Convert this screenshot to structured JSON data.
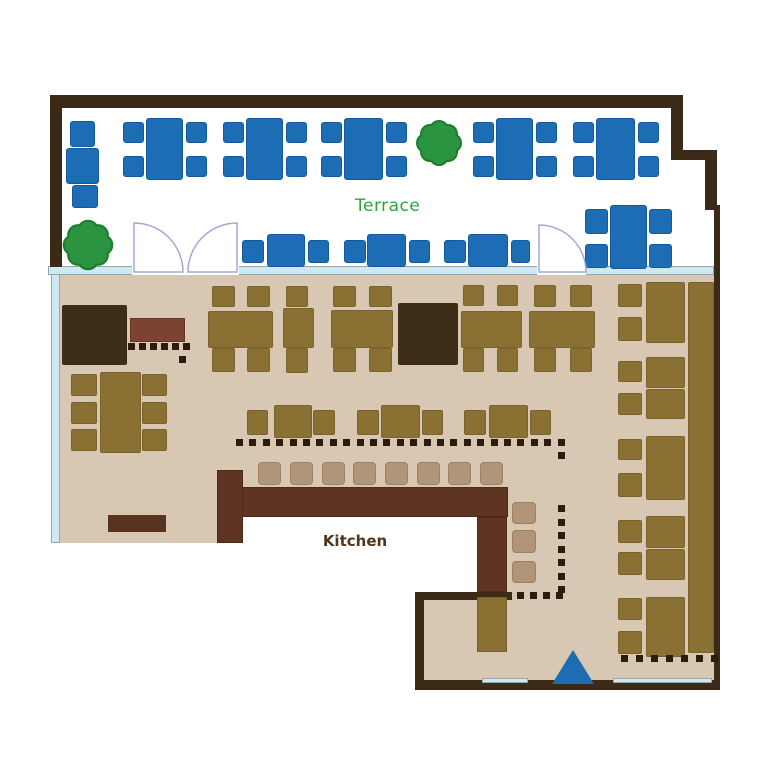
{
  "labels": {
    "terrace": "Terrace",
    "counter": "カウンター",
    "kitchen": "Kitchen"
  },
  "colors": {
    "wall": "#3a2a16",
    "floor": "#d8c7b2",
    "window": "#cfe9f3",
    "white": "#ffffff",
    "blue": "#1d6db5",
    "olive": "#8b7033",
    "dark": "#3f2e17",
    "counter": "#5f3422",
    "stool": "#b29478",
    "red": "#7d4331",
    "ledge": "#57341f",
    "dot": "#2b1c0e",
    "tree": "#2b9440",
    "treeStroke": "#1d7c2d",
    "door": "#a3a8d6",
    "terraceText": "#2aa53c",
    "kitchenText": "#54351b",
    "counterText": "#ffffff"
  },
  "borders": {
    "blue": "#1359a2",
    "olive": "#7a632b",
    "stool": "#9e8164",
    "window": "#97a6ad",
    "counter": "#4e2a18",
    "red": "#6a3322"
  },
  "shapes": [
    {
      "n": "indoor-floor-main",
      "c": "floor",
      "x": 58,
      "y": 275,
      "w": 656,
      "h": 242
    },
    {
      "n": "indoor-floor-left-lip",
      "c": "floor",
      "x": 58,
      "y": 517,
      "w": 160,
      "h": 26
    },
    {
      "n": "indoor-floor-right",
      "c": "floor",
      "x": 507,
      "y": 517,
      "w": 207,
      "h": 167
    },
    {
      "n": "indoor-floor-bottom-mid",
      "c": "floor",
      "x": 424,
      "y": 600,
      "w": 83,
      "h": 84
    },
    {
      "n": "window-band-left",
      "c": "window",
      "x": 51,
      "y": 266,
      "w": 9,
      "h": 277
    },
    {
      "n": "terrace-divider-band",
      "c": "window",
      "x": 48,
      "y": 266,
      "w": 666,
      "h": 9
    },
    {
      "n": "divider-door-gap",
      "c": "white",
      "x": 132,
      "y": 266,
      "w": 107,
      "h": 9
    },
    {
      "n": "divider-door-gap",
      "c": "white",
      "x": 537,
      "y": 266,
      "w": 49,
      "h": 9
    },
    {
      "n": "wall-top",
      "c": "wall",
      "x": 50,
      "y": 95,
      "w": 633,
      "h": 13
    },
    {
      "n": "wall-left",
      "c": "wall",
      "x": 50,
      "y": 95,
      "w": 12,
      "h": 172
    },
    {
      "n": "wall-right-upper",
      "c": "wall",
      "x": 671,
      "y": 95,
      "w": 12,
      "h": 62
    },
    {
      "n": "wall-right-step",
      "c": "wall",
      "x": 671,
      "y": 150,
      "w": 46,
      "h": 10
    },
    {
      "n": "wall-right-mid",
      "c": "wall",
      "x": 705,
      "y": 150,
      "w": 12,
      "h": 60
    },
    {
      "n": "wall-right-thin",
      "c": "wall",
      "x": 714,
      "y": 205,
      "w": 6,
      "h": 485
    },
    {
      "n": "wall-bottom",
      "c": "wall",
      "x": 415,
      "y": 680,
      "w": 305,
      "h": 10
    },
    {
      "n": "wall-kitchen-corner-v",
      "c": "wall",
      "x": 415,
      "y": 592,
      "w": 9,
      "h": 95
    },
    {
      "n": "wall-kitchen-corner-h",
      "c": "wall",
      "x": 415,
      "y": 592,
      "w": 97,
      "h": 8
    },
    {
      "n": "entrance-glass",
      "c": "window",
      "x": 482,
      "y": 678,
      "w": 46,
      "h": 5
    },
    {
      "n": "entrance-glass",
      "c": "window",
      "x": 613,
      "y": 678,
      "w": 99,
      "h": 5
    },
    {
      "n": "private-room-block",
      "c": "dark",
      "x": 62,
      "y": 305,
      "w": 65,
      "h": 60,
      "r": 2
    },
    {
      "n": "private-room-block",
      "c": "dark",
      "x": 398,
      "y": 303,
      "w": 60,
      "h": 62,
      "r": 2
    },
    {
      "n": "service-bench",
      "c": "red",
      "x": 130,
      "y": 318,
      "w": 55,
      "h": 24
    },
    {
      "n": "bottom-ledge",
      "c": "ledge",
      "x": 108,
      "y": 515,
      "w": 58,
      "h": 17
    },
    {
      "n": "terrace-chair",
      "c": "blue",
      "x": 70,
      "y": 121,
      "w": 25,
      "h": 26,
      "r": 3
    },
    {
      "n": "terrace-table",
      "c": "blue",
      "x": 66,
      "y": 148,
      "w": 33,
      "h": 36,
      "r": 3
    },
    {
      "n": "terrace-chair",
      "c": "blue",
      "x": 72,
      "y": 185,
      "w": 26,
      "h": 23,
      "r": 3
    },
    {
      "n": "terrace-table",
      "c": "blue",
      "x": 146,
      "y": 118,
      "w": 37,
      "h": 62,
      "r": 3
    },
    {
      "n": "terrace-chair",
      "c": "blue",
      "x": 123,
      "y": 122,
      "w": 21,
      "h": 21,
      "r": 3
    },
    {
      "n": "terrace-chair",
      "c": "blue",
      "x": 123,
      "y": 156,
      "w": 21,
      "h": 21,
      "r": 3
    },
    {
      "n": "terrace-chair",
      "c": "blue",
      "x": 186,
      "y": 122,
      "w": 21,
      "h": 21,
      "r": 3
    },
    {
      "n": "terrace-chair",
      "c": "blue",
      "x": 186,
      "y": 156,
      "w": 21,
      "h": 21,
      "r": 3
    },
    {
      "n": "terrace-table",
      "c": "blue",
      "x": 246,
      "y": 118,
      "w": 37,
      "h": 62,
      "r": 3
    },
    {
      "n": "terrace-chair",
      "c": "blue",
      "x": 223,
      "y": 122,
      "w": 21,
      "h": 21,
      "r": 3
    },
    {
      "n": "terrace-chair",
      "c": "blue",
      "x": 223,
      "y": 156,
      "w": 21,
      "h": 21,
      "r": 3
    },
    {
      "n": "terrace-chair",
      "c": "blue",
      "x": 286,
      "y": 122,
      "w": 21,
      "h": 21,
      "r": 3
    },
    {
      "n": "terrace-chair",
      "c": "blue",
      "x": 286,
      "y": 156,
      "w": 21,
      "h": 21,
      "r": 3
    },
    {
      "n": "terrace-table",
      "c": "blue",
      "x": 344,
      "y": 118,
      "w": 39,
      "h": 62,
      "r": 3
    },
    {
      "n": "terrace-chair",
      "c": "blue",
      "x": 321,
      "y": 122,
      "w": 21,
      "h": 21,
      "r": 3
    },
    {
      "n": "terrace-chair",
      "c": "blue",
      "x": 321,
      "y": 156,
      "w": 21,
      "h": 21,
      "r": 3
    },
    {
      "n": "terrace-chair",
      "c": "blue",
      "x": 386,
      "y": 122,
      "w": 21,
      "h": 21,
      "r": 3
    },
    {
      "n": "terrace-chair",
      "c": "blue",
      "x": 386,
      "y": 156,
      "w": 21,
      "h": 21,
      "r": 3
    },
    {
      "n": "terrace-table",
      "c": "blue",
      "x": 496,
      "y": 118,
      "w": 37,
      "h": 62,
      "r": 3
    },
    {
      "n": "terrace-chair",
      "c": "blue",
      "x": 473,
      "y": 122,
      "w": 21,
      "h": 21,
      "r": 3
    },
    {
      "n": "terrace-chair",
      "c": "blue",
      "x": 473,
      "y": 156,
      "w": 21,
      "h": 21,
      "r": 3
    },
    {
      "n": "terrace-chair",
      "c": "blue",
      "x": 536,
      "y": 122,
      "w": 21,
      "h": 21,
      "r": 3
    },
    {
      "n": "terrace-chair",
      "c": "blue",
      "x": 536,
      "y": 156,
      "w": 21,
      "h": 21,
      "r": 3
    },
    {
      "n": "terrace-table",
      "c": "blue",
      "x": 596,
      "y": 118,
      "w": 39,
      "h": 62,
      "r": 3
    },
    {
      "n": "terrace-chair",
      "c": "blue",
      "x": 573,
      "y": 122,
      "w": 21,
      "h": 21,
      "r": 3
    },
    {
      "n": "terrace-chair",
      "c": "blue",
      "x": 573,
      "y": 156,
      "w": 21,
      "h": 21,
      "r": 3
    },
    {
      "n": "terrace-chair",
      "c": "blue",
      "x": 638,
      "y": 122,
      "w": 21,
      "h": 21,
      "r": 3
    },
    {
      "n": "terrace-chair",
      "c": "blue",
      "x": 638,
      "y": 156,
      "w": 21,
      "h": 21,
      "r": 3
    },
    {
      "n": "terrace-chair",
      "c": "blue",
      "x": 242,
      "y": 240,
      "w": 22,
      "h": 23,
      "r": 3
    },
    {
      "n": "terrace-table",
      "c": "blue",
      "x": 267,
      "y": 234,
      "w": 38,
      "h": 33,
      "r": 3
    },
    {
      "n": "terrace-chair",
      "c": "blue",
      "x": 308,
      "y": 240,
      "w": 21,
      "h": 23,
      "r": 3
    },
    {
      "n": "terrace-chair",
      "c": "blue",
      "x": 344,
      "y": 240,
      "w": 22,
      "h": 23,
      "r": 3
    },
    {
      "n": "terrace-table",
      "c": "blue",
      "x": 367,
      "y": 234,
      "w": 39,
      "h": 33,
      "r": 3
    },
    {
      "n": "terrace-chair",
      "c": "blue",
      "x": 409,
      "y": 240,
      "w": 21,
      "h": 23,
      "r": 3
    },
    {
      "n": "terrace-chair",
      "c": "blue",
      "x": 444,
      "y": 240,
      "w": 22,
      "h": 23,
      "r": 3
    },
    {
      "n": "terrace-table",
      "c": "blue",
      "x": 468,
      "y": 234,
      "w": 40,
      "h": 33,
      "r": 3
    },
    {
      "n": "terrace-chair",
      "c": "blue",
      "x": 511,
      "y": 240,
      "w": 19,
      "h": 23,
      "r": 3
    },
    {
      "n": "terrace-table",
      "c": "blue",
      "x": 610,
      "y": 205,
      "w": 37,
      "h": 64,
      "r": 3
    },
    {
      "n": "terrace-chair",
      "c": "blue",
      "x": 585,
      "y": 209,
      "w": 23,
      "h": 25,
      "r": 3
    },
    {
      "n": "terrace-chair",
      "c": "blue",
      "x": 585,
      "y": 244,
      "w": 23,
      "h": 24,
      "r": 3
    },
    {
      "n": "terrace-chair",
      "c": "blue",
      "x": 649,
      "y": 209,
      "w": 23,
      "h": 25,
      "r": 3
    },
    {
      "n": "terrace-chair",
      "c": "blue",
      "x": 649,
      "y": 244,
      "w": 23,
      "h": 24,
      "r": 3
    },
    {
      "n": "dining-table",
      "c": "olive",
      "x": 208,
      "y": 311,
      "w": 65,
      "h": 37,
      "r": 2
    },
    {
      "n": "dining-chair",
      "c": "olive",
      "x": 212,
      "y": 286,
      "w": 23,
      "h": 21,
      "r": 2
    },
    {
      "n": "dining-chair",
      "c": "olive",
      "x": 247,
      "y": 286,
      "w": 23,
      "h": 21,
      "r": 2
    },
    {
      "n": "dining-chair",
      "c": "olive",
      "x": 212,
      "y": 348,
      "w": 23,
      "h": 24,
      "r": 2
    },
    {
      "n": "dining-chair",
      "c": "olive",
      "x": 247,
      "y": 348,
      "w": 23,
      "h": 24,
      "r": 2
    },
    {
      "n": "dining-table",
      "c": "olive",
      "x": 283,
      "y": 308,
      "w": 31,
      "h": 40,
      "r": 2
    },
    {
      "n": "dining-chair",
      "c": "olive",
      "x": 286,
      "y": 286,
      "w": 22,
      "h": 21,
      "r": 2
    },
    {
      "n": "dining-chair",
      "c": "olive",
      "x": 286,
      "y": 348,
      "w": 22,
      "h": 25,
      "r": 2
    },
    {
      "n": "dining-table",
      "c": "olive",
      "x": 331,
      "y": 310,
      "w": 62,
      "h": 38,
      "r": 2
    },
    {
      "n": "dining-chair",
      "c": "olive",
      "x": 333,
      "y": 286,
      "w": 23,
      "h": 21,
      "r": 2
    },
    {
      "n": "dining-chair",
      "c": "olive",
      "x": 369,
      "y": 286,
      "w": 23,
      "h": 21,
      "r": 2
    },
    {
      "n": "dining-chair",
      "c": "olive",
      "x": 333,
      "y": 348,
      "w": 23,
      "h": 24,
      "r": 2
    },
    {
      "n": "dining-chair",
      "c": "olive",
      "x": 369,
      "y": 348,
      "w": 23,
      "h": 24,
      "r": 2
    },
    {
      "n": "dining-table",
      "c": "olive",
      "x": 461,
      "y": 311,
      "w": 61,
      "h": 37,
      "r": 2
    },
    {
      "n": "dining-chair",
      "c": "olive",
      "x": 463,
      "y": 285,
      "w": 21,
      "h": 21,
      "r": 2
    },
    {
      "n": "dining-chair",
      "c": "olive",
      "x": 497,
      "y": 285,
      "w": 21,
      "h": 21,
      "r": 2
    },
    {
      "n": "dining-chair",
      "c": "olive",
      "x": 463,
      "y": 348,
      "w": 21,
      "h": 24,
      "r": 2
    },
    {
      "n": "dining-chair",
      "c": "olive",
      "x": 497,
      "y": 348,
      "w": 21,
      "h": 24,
      "r": 2
    },
    {
      "n": "dining-table",
      "c": "olive",
      "x": 529,
      "y": 311,
      "w": 66,
      "h": 37,
      "r": 2
    },
    {
      "n": "dining-chair",
      "c": "olive",
      "x": 534,
      "y": 285,
      "w": 22,
      "h": 22,
      "r": 2
    },
    {
      "n": "dining-chair",
      "c": "olive",
      "x": 570,
      "y": 285,
      "w": 22,
      "h": 22,
      "r": 2
    },
    {
      "n": "dining-chair",
      "c": "olive",
      "x": 534,
      "y": 348,
      "w": 22,
      "h": 24,
      "r": 2
    },
    {
      "n": "dining-chair",
      "c": "olive",
      "x": 570,
      "y": 348,
      "w": 22,
      "h": 24,
      "r": 2
    },
    {
      "n": "dining-table",
      "c": "olive",
      "x": 100,
      "y": 372,
      "w": 41,
      "h": 81,
      "r": 2
    },
    {
      "n": "dining-chair",
      "c": "olive",
      "x": 71,
      "y": 374,
      "w": 26,
      "h": 22,
      "r": 2
    },
    {
      "n": "dining-chair",
      "c": "olive",
      "x": 71,
      "y": 402,
      "w": 26,
      "h": 22,
      "r": 2
    },
    {
      "n": "dining-chair",
      "c": "olive",
      "x": 71,
      "y": 429,
      "w": 26,
      "h": 22,
      "r": 2
    },
    {
      "n": "dining-chair",
      "c": "olive",
      "x": 142,
      "y": 374,
      "w": 25,
      "h": 22,
      "r": 2
    },
    {
      "n": "dining-chair",
      "c": "olive",
      "x": 142,
      "y": 402,
      "w": 25,
      "h": 22,
      "r": 2
    },
    {
      "n": "dining-chair",
      "c": "olive",
      "x": 142,
      "y": 429,
      "w": 25,
      "h": 22,
      "r": 2
    },
    {
      "n": "dining-chair",
      "c": "olive",
      "x": 247,
      "y": 410,
      "w": 21,
      "h": 25,
      "r": 2
    },
    {
      "n": "dining-table",
      "c": "olive",
      "x": 274,
      "y": 405,
      "w": 38,
      "h": 33,
      "r": 2
    },
    {
      "n": "dining-chair",
      "c": "olive",
      "x": 313,
      "y": 410,
      "w": 22,
      "h": 25,
      "r": 2
    },
    {
      "n": "dining-chair",
      "c": "olive",
      "x": 357,
      "y": 410,
      "w": 22,
      "h": 25,
      "r": 2
    },
    {
      "n": "dining-table",
      "c": "olive",
      "x": 381,
      "y": 405,
      "w": 39,
      "h": 33,
      "r": 2
    },
    {
      "n": "dining-chair",
      "c": "olive",
      "x": 422,
      "y": 410,
      "w": 21,
      "h": 25,
      "r": 2
    },
    {
      "n": "dining-chair",
      "c": "olive",
      "x": 464,
      "y": 410,
      "w": 22,
      "h": 25,
      "r": 2
    },
    {
      "n": "dining-table",
      "c": "olive",
      "x": 489,
      "y": 405,
      "w": 39,
      "h": 33,
      "r": 2
    },
    {
      "n": "dining-chair",
      "c": "olive",
      "x": 530,
      "y": 410,
      "w": 21,
      "h": 25,
      "r": 2
    },
    {
      "n": "booth-bench",
      "c": "olive",
      "x": 688,
      "y": 282,
      "w": 26,
      "h": 371,
      "r": 2
    },
    {
      "n": "booth-table",
      "c": "olive",
      "x": 646,
      "y": 282,
      "w": 39,
      "h": 61,
      "r": 2
    },
    {
      "n": "booth-chair",
      "c": "olive",
      "x": 618,
      "y": 284,
      "w": 24,
      "h": 23,
      "r": 2
    },
    {
      "n": "booth-chair",
      "c": "olive",
      "x": 618,
      "y": 317,
      "w": 24,
      "h": 24,
      "r": 2
    },
    {
      "n": "booth-table",
      "c": "olive",
      "x": 646,
      "y": 357,
      "w": 39,
      "h": 31,
      "r": 2
    },
    {
      "n": "booth-table",
      "c": "olive",
      "x": 646,
      "y": 389,
      "w": 39,
      "h": 30,
      "r": 2
    },
    {
      "n": "booth-chair",
      "c": "olive",
      "x": 618,
      "y": 361,
      "w": 24,
      "h": 21,
      "r": 2
    },
    {
      "n": "booth-chair",
      "c": "olive",
      "x": 618,
      "y": 393,
      "w": 24,
      "h": 22,
      "r": 2
    },
    {
      "n": "booth-table",
      "c": "olive",
      "x": 646,
      "y": 436,
      "w": 39,
      "h": 64,
      "r": 2
    },
    {
      "n": "booth-chair",
      "c": "olive",
      "x": 618,
      "y": 439,
      "w": 24,
      "h": 21,
      "r": 2
    },
    {
      "n": "booth-chair",
      "c": "olive",
      "x": 618,
      "y": 473,
      "w": 24,
      "h": 24,
      "r": 2
    },
    {
      "n": "booth-table",
      "c": "olive",
      "x": 646,
      "y": 516,
      "w": 39,
      "h": 32,
      "r": 2
    },
    {
      "n": "booth-table",
      "c": "olive",
      "x": 646,
      "y": 549,
      "w": 39,
      "h": 31,
      "r": 2
    },
    {
      "n": "booth-chair",
      "c": "olive",
      "x": 618,
      "y": 520,
      "w": 24,
      "h": 23,
      "r": 2
    },
    {
      "n": "booth-chair",
      "c": "olive",
      "x": 618,
      "y": 552,
      "w": 24,
      "h": 23,
      "r": 2
    },
    {
      "n": "booth-table",
      "c": "olive",
      "x": 646,
      "y": 597,
      "w": 39,
      "h": 60,
      "r": 2
    },
    {
      "n": "booth-chair",
      "c": "olive",
      "x": 618,
      "y": 598,
      "w": 24,
      "h": 22,
      "r": 2
    },
    {
      "n": "booth-chair",
      "c": "olive",
      "x": 618,
      "y": 631,
      "w": 24,
      "h": 23,
      "r": 2
    },
    {
      "n": "counter-bar",
      "c": "counter",
      "x": 242,
      "y": 487,
      "w": 266,
      "h": 30
    },
    {
      "n": "counter-left-stub",
      "c": "counter",
      "x": 217,
      "y": 470,
      "w": 26,
      "h": 73
    },
    {
      "n": "counter-right-stub",
      "c": "counter",
      "x": 477,
      "y": 517,
      "w": 30,
      "h": 75
    },
    {
      "n": "service-station",
      "c": "olive",
      "x": 477,
      "y": 597,
      "w": 30,
      "h": 55
    },
    {
      "n": "counter-stool",
      "c": "stool",
      "x": 258,
      "y": 462,
      "w": 23,
      "h": 23,
      "r": 4
    },
    {
      "n": "counter-stool",
      "c": "stool",
      "x": 290,
      "y": 462,
      "w": 23,
      "h": 23,
      "r": 4
    },
    {
      "n": "counter-stool",
      "c": "stool",
      "x": 322,
      "y": 462,
      "w": 23,
      "h": 23,
      "r": 4
    },
    {
      "n": "counter-stool",
      "c": "stool",
      "x": 353,
      "y": 462,
      "w": 23,
      "h": 23,
      "r": 4
    },
    {
      "n": "counter-stool",
      "c": "stool",
      "x": 385,
      "y": 462,
      "w": 23,
      "h": 23,
      "r": 4
    },
    {
      "n": "counter-stool",
      "c": "stool",
      "x": 417,
      "y": 462,
      "w": 23,
      "h": 23,
      "r": 4
    },
    {
      "n": "counter-stool",
      "c": "stool",
      "x": 448,
      "y": 462,
      "w": 23,
      "h": 23,
      "r": 4
    },
    {
      "n": "counter-stool",
      "c": "stool",
      "x": 480,
      "y": 462,
      "w": 23,
      "h": 23,
      "r": 4
    },
    {
      "n": "counter-stool",
      "c": "stool",
      "x": 512,
      "y": 502,
      "w": 24,
      "h": 22,
      "r": 4
    },
    {
      "n": "counter-stool",
      "c": "stool",
      "x": 512,
      "y": 530,
      "w": 24,
      "h": 23,
      "r": 4
    },
    {
      "n": "counter-stool",
      "c": "stool",
      "x": 512,
      "y": 561,
      "w": 24,
      "h": 22,
      "r": 4
    },
    {
      "n": "bench-dot-row",
      "dots": 6,
      "x": 128,
      "y": 343,
      "dx": 11,
      "dy": 0
    },
    {
      "n": "bench-dot",
      "dots": 1,
      "x": 179,
      "y": 356,
      "dx": 0,
      "dy": 0
    },
    {
      "n": "partition-dots-main",
      "dots": 25,
      "x": 236,
      "y": 439,
      "dx": 13.4,
      "dy": 0
    },
    {
      "n": "partition-dot-corner",
      "dots": 1,
      "x": 558,
      "y": 452,
      "dx": 0,
      "dy": 0
    },
    {
      "n": "partition-dots-vertical",
      "dots": 7,
      "x": 558,
      "y": 505,
      "dx": 0,
      "dy": 13.5
    },
    {
      "n": "partition-dots-bottom",
      "dots": 4,
      "x": 517,
      "y": 592,
      "dx": 13,
      "dy": 0
    },
    {
      "n": "partition-dots-right",
      "dots": 7,
      "x": 621,
      "y": 655,
      "dx": 15,
      "dy": 0
    }
  ]
}
